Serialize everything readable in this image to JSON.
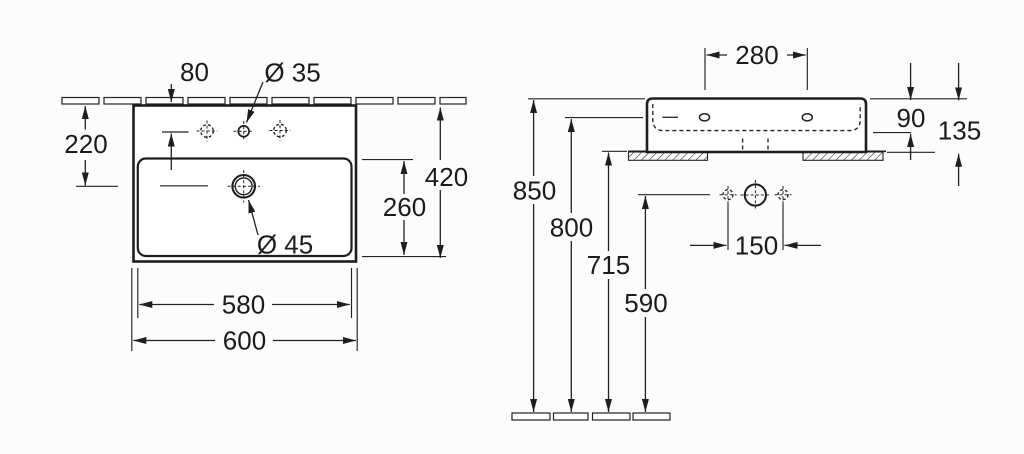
{
  "colors": {
    "line": "#222222",
    "text": "#1b1b1b",
    "background": "#fcfcfc"
  },
  "front_view": {
    "dims": {
      "tap_hole_setback": "80",
      "tap_hole_diameter": "Ø 35",
      "drain_setback": "220",
      "overall_depth": "420",
      "bowl_depth": "260",
      "drain_diameter": "Ø 45",
      "bowl_width": "580",
      "overall_width": "600"
    }
  },
  "side_view": {
    "dims": {
      "fixing_hole_centres": "280",
      "bowl_inner_depth": "90",
      "body_height": "135",
      "rim_height": "850",
      "fixing_height": "800",
      "shelf_height": "715",
      "trap_height": "590",
      "supply_centres": "150"
    }
  }
}
